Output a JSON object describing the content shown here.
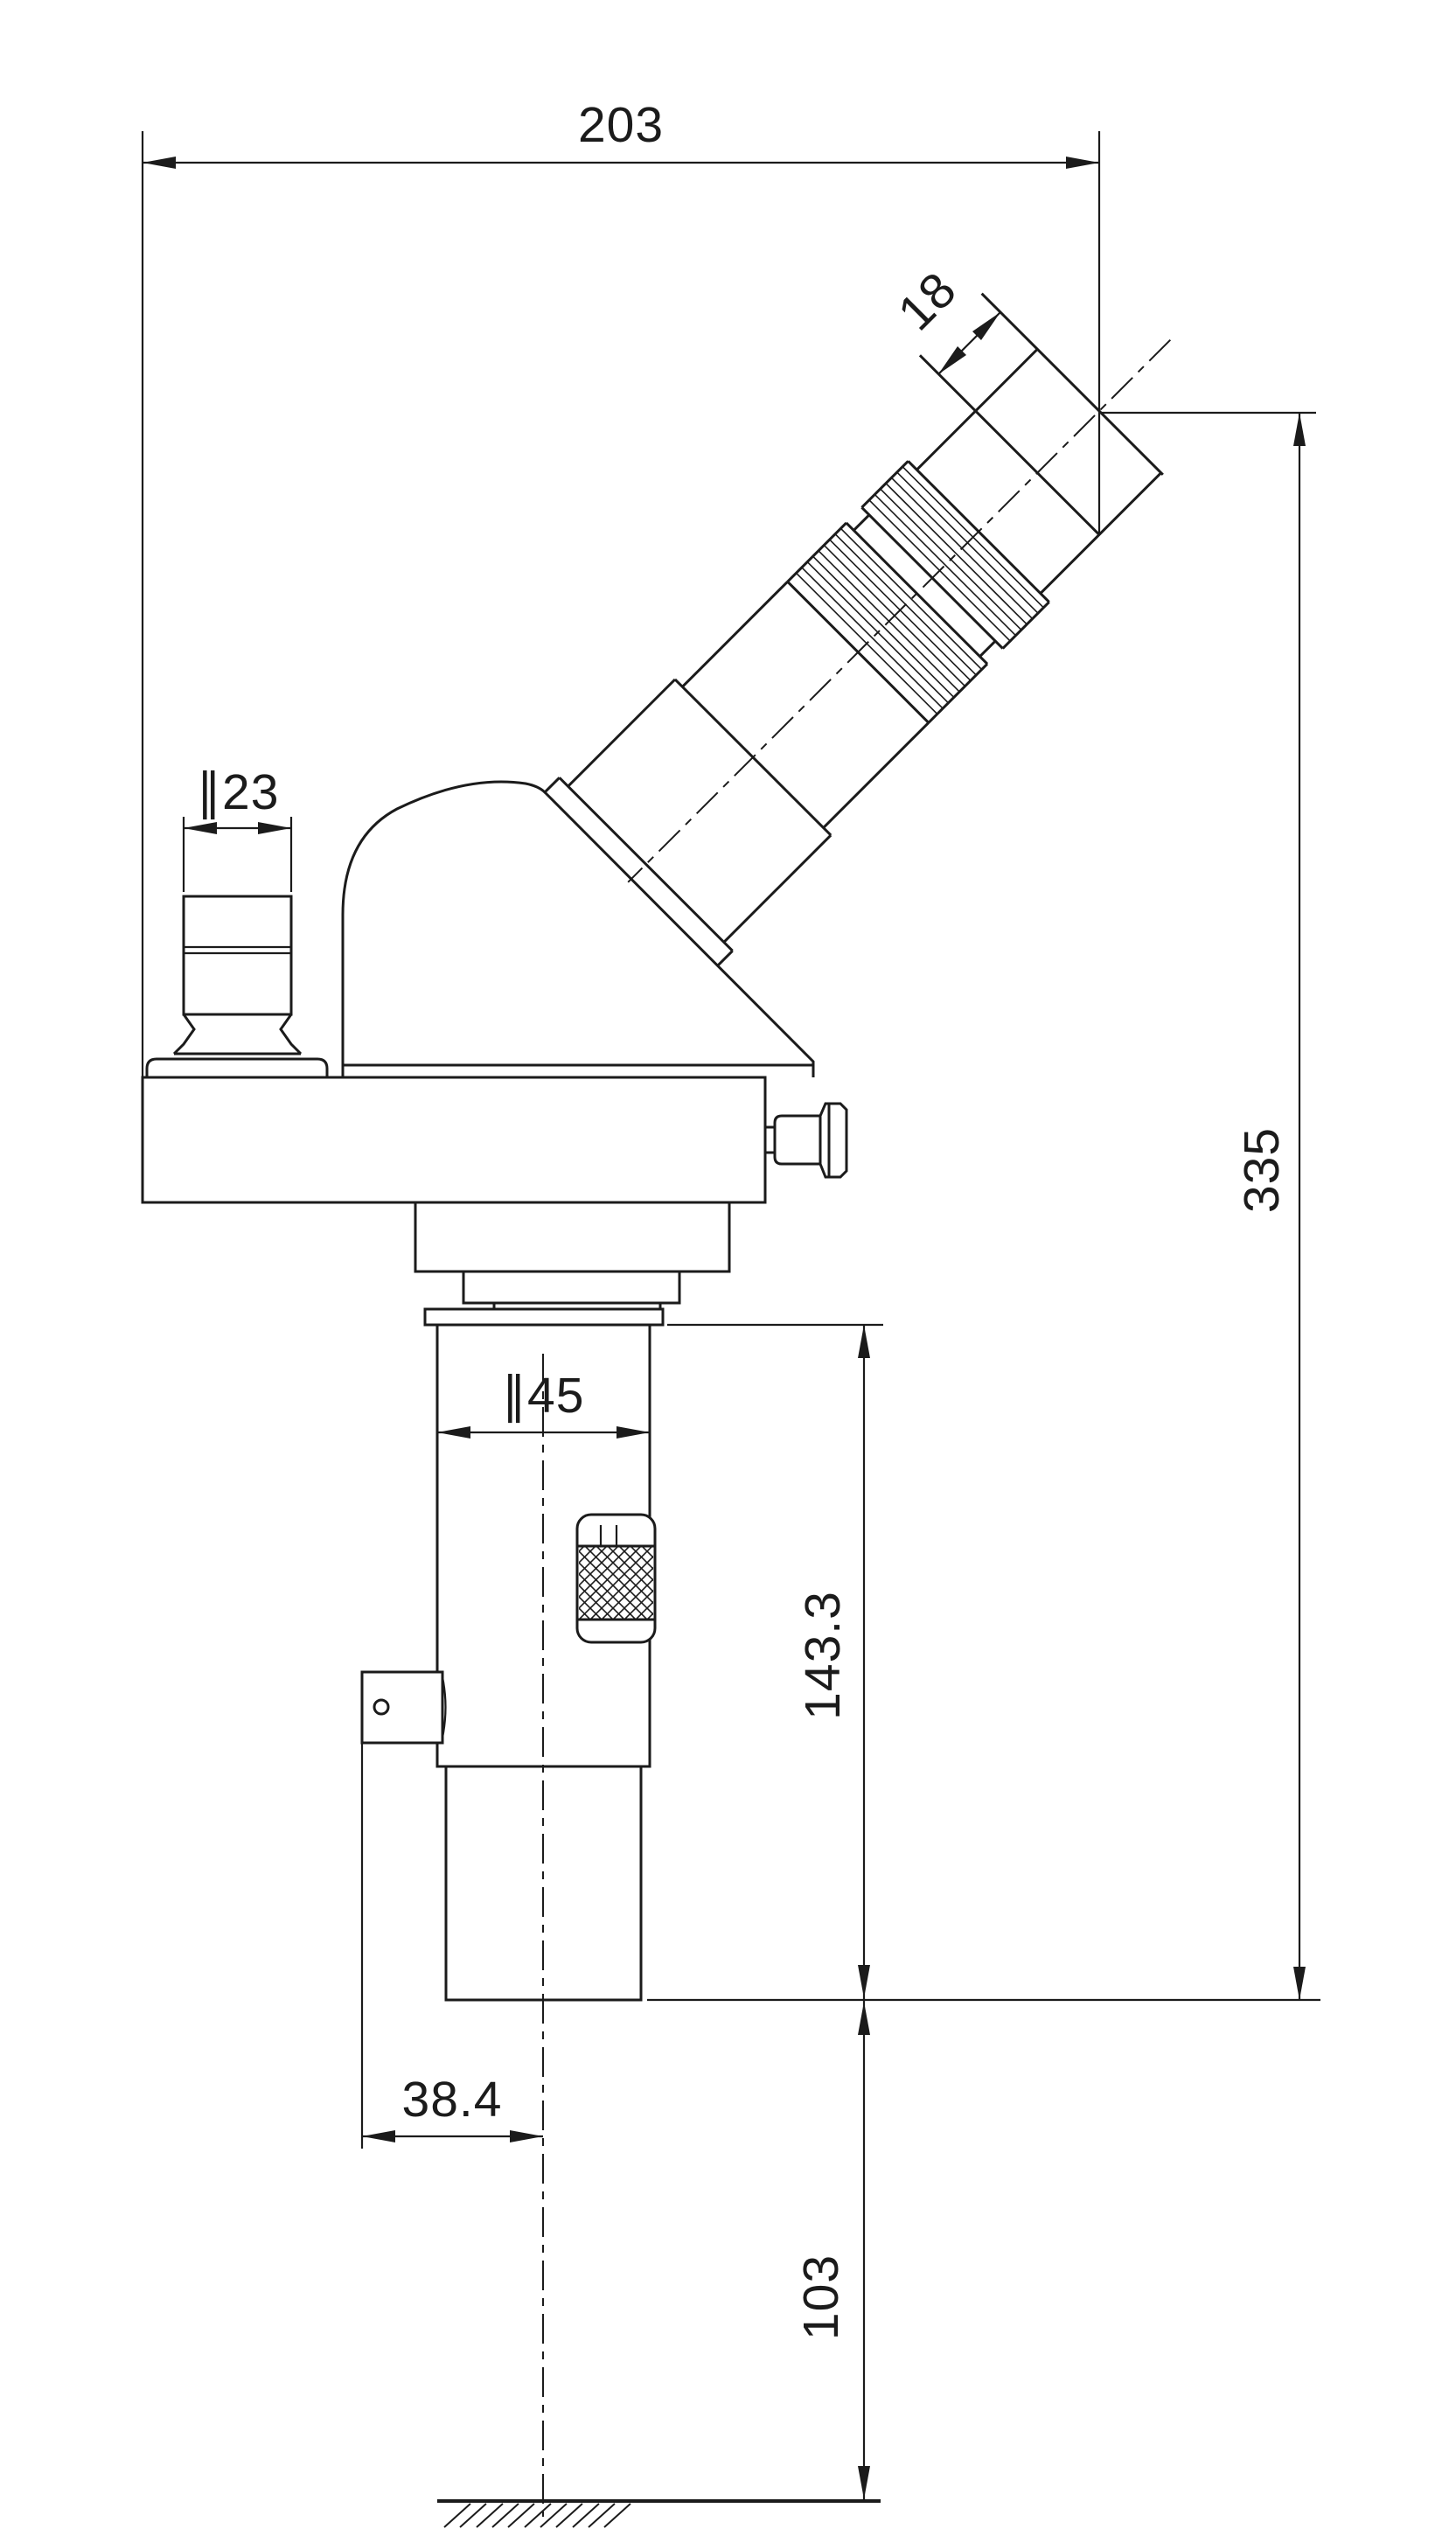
{
  "drawing": {
    "background": "#ffffff",
    "line_color": "#1b1b1b",
    "view": "microscope-side-elevation",
    "dimensions": {
      "overall_width": "203",
      "eyepiece_end_length": "18",
      "port_diameter": "∥23",
      "focus_tube_diameter": "∥45",
      "overall_height": "335",
      "focus_section_height": "143.3",
      "axis_offset": "38.4",
      "working_distance": "103"
    }
  }
}
